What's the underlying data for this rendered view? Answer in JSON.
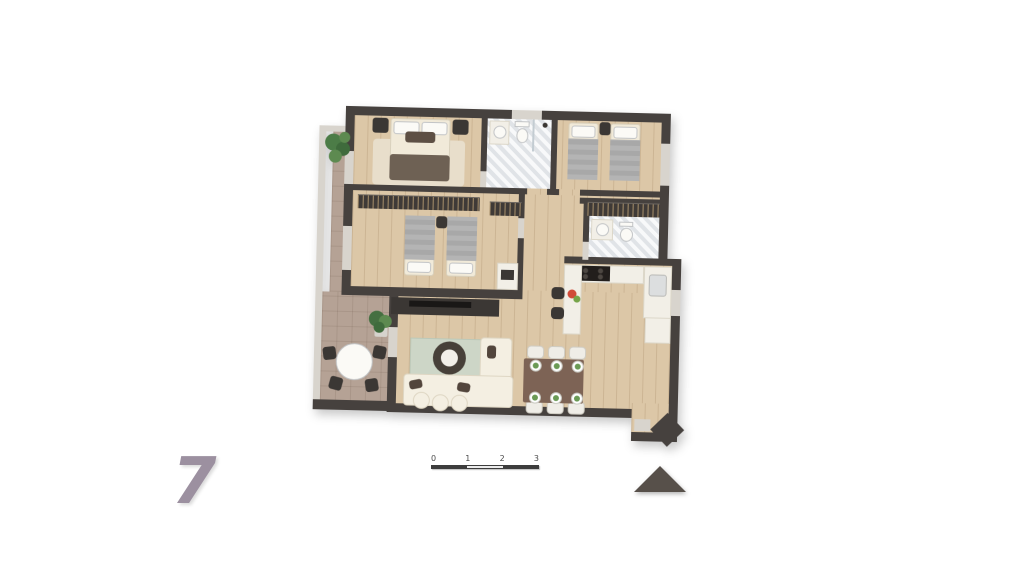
{
  "annotations": {
    "unit_number": "7",
    "scale_ticks": [
      "0",
      "1",
      "2",
      "3"
    ]
  },
  "compass": {
    "icon": "north-arrow-triangle",
    "direction": "up"
  },
  "colors": {
    "background": "#ffffff",
    "wall": "#46413e",
    "wall_light": "#d8d4cd",
    "wood": "#dcc7a7",
    "balcony": "#b5a295",
    "marble": "#eceef0",
    "cream": "#f1ead9",
    "blanket_gray": "#a8a8a8",
    "blanket_brown": "#6e6154",
    "furniture_dark": "#3b3734",
    "rug_sage": "#cdd6c7",
    "rug_beige": "#e8decb",
    "sofa": "#f4efe2",
    "table_brown": "#7d6355",
    "chair_white": "#efede7",
    "counter": "#f2efe7",
    "plant_green": "#4c7c47",
    "unit_number": "#9c90a0",
    "scale_dark": "#3d3d3d",
    "north_arrow": "#57504a"
  },
  "rooms": [
    {
      "name": "bedroom-1",
      "furniture": [
        "double-bed",
        "nightstand-left",
        "nightstand-right",
        "rug",
        "wardrobe-row"
      ]
    },
    {
      "name": "bathroom-1",
      "furniture": [
        "sink",
        "toilet",
        "shower"
      ]
    },
    {
      "name": "bedroom-2",
      "furniture": [
        "single-bed",
        "single-bed",
        "nightstand"
      ]
    },
    {
      "name": "bedroom-3",
      "furniture": [
        "single-bed",
        "single-bed",
        "nightstand",
        "wardrobe-row",
        "cabinet"
      ]
    },
    {
      "name": "bathroom-2",
      "furniture": [
        "sink",
        "toilet",
        "wardrobe-row"
      ]
    },
    {
      "name": "kitchen",
      "furniture": [
        "cooktop-counter",
        "sink-counter",
        "base-cabinet",
        "breakfast-bar",
        "bar-stool",
        "bar-stool",
        "fruit-bowl"
      ]
    },
    {
      "name": "living-dining",
      "furniture": [
        "corner-sofa",
        "poufs",
        "coffee-table",
        "rug",
        "tv-unit",
        "dining-table",
        "dining-chairs-6",
        "plates-6"
      ]
    },
    {
      "name": "balcony",
      "furniture": [
        "round-table",
        "chairs-4",
        "potted-plant",
        "potted-plant"
      ]
    },
    {
      "name": "entry",
      "furniture": [
        "threshold"
      ]
    }
  ]
}
